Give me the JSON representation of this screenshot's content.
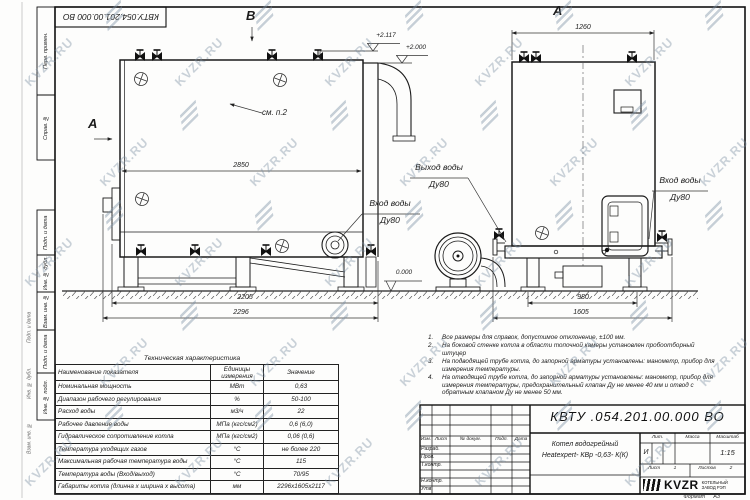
{
  "watermark": {
    "text": "KVZR.RU"
  },
  "top_stamp": {
    "doc_number": "КВТУ.054.201.00.000 ВО"
  },
  "frame_labels": [
    "Перв. примен.",
    "Справ. №",
    "Подп. и дата",
    "Инв. № дубл.",
    "Взам. инв. №",
    "Подп. и дата",
    "Инв. № подл."
  ],
  "drawing": {
    "section_marks": {
      "a_left": "А",
      "b_top": "В",
      "a_right": "А"
    },
    "labels": {
      "see_note": "см. п.2",
      "outlet_title": "Выход воды",
      "outlet_dn": "Ду80",
      "inlet_title": "Вход воды",
      "inlet_dn": "Ду80",
      "inlet_right_title": "Вход воды",
      "inlet_right_dn": "Ду80"
    },
    "elevations": {
      "top": "+2.117",
      "duct": "+2.000",
      "ground": "0.000"
    },
    "dimensions": {
      "left_length": "2850",
      "left_base": "2205",
      "left_overall": "2296",
      "right_width": "1260",
      "right_base": "980",
      "right_overall": "1605"
    }
  },
  "tech_table": {
    "title": "Техническая характеристика",
    "headers": {
      "name": "Наименование показателя",
      "units": "Единицы измерения",
      "value": "Значение"
    },
    "rows": [
      {
        "name": "Номинальная мощность",
        "units": "МВт",
        "value": "0,63"
      },
      {
        "name": "Диапазон рабочего регулирования",
        "units": "%",
        "value": "50-100"
      },
      {
        "name": "Расход воды",
        "units": "м3/ч",
        "value": "22"
      },
      {
        "name": "Рабочее давление воды",
        "units": "МПа (кгс/см2)",
        "value": "0,6 (6,0)"
      },
      {
        "name": "Гидравлическое сопротивление котла",
        "units": "МПа (кгс/см2)",
        "value": "0,06 (0,6)"
      },
      {
        "name": "Температура уходящих газов",
        "units": "°С",
        "value": "не более 220"
      },
      {
        "name": "Максимальная рабочая температура воды",
        "units": "°С",
        "value": "115"
      },
      {
        "name": "Температура воды (Вход/выход)",
        "units": "°С",
        "value": "70/95"
      },
      {
        "name": "Габариты котла (длинна х ширина х высота)",
        "units": "мм",
        "value": "2296х1605х2117"
      }
    ]
  },
  "notes": [
    {
      "num": "1.",
      "text": "Все размеры для справок, допустимое отклонение, ±100 мм."
    },
    {
      "num": "2.",
      "text": "На боковой стенке котла в области топочной камеры установлен пробоотборный штуцер"
    },
    {
      "num": "3.",
      "text": "На подводящей трубе котла, до запорной арматуры установлены: манометр, прибор для измерения температуры."
    },
    {
      "num": "4.",
      "text": "На отводящей трубе котла, до запорной арматуры установлены: манометр, прибор для измерения температуры, предохранительный клапан Ду не менее 40 мм и отвод с обратным клапаном Ду не менее 50 мм."
    }
  ],
  "title_block": {
    "doc_number": "КВТУ .054.201.00.000 ВО",
    "product_name_line1": "Котел водогрейный",
    "product_name_line2": "Heatexpert- КВр -0,63- К(К)",
    "columns": {
      "izm": "Изм.",
      "list": "Лист",
      "doc": "№ докум.",
      "podp": "Подп.",
      "data": "Дата"
    },
    "rows": [
      "Разраб.",
      "Пров.",
      "Т.контр.",
      "",
      "Н.контр.",
      "Утв."
    ],
    "lit_label": "Лит.",
    "lit_value": "И",
    "mass_label": "Масса",
    "scale_label": "Масштаб",
    "scale_value": "1:15",
    "sheet_label": "Лист",
    "sheet_value": "1",
    "sheets_label": "Листов",
    "sheets_value": "2",
    "logo_text": "KVZR",
    "logo_sub1": "КОТЕЛЬНЫЙ",
    "logo_sub2": "ЗАВОД РЭП",
    "format_label": "Формат",
    "format_value": "А3"
  }
}
